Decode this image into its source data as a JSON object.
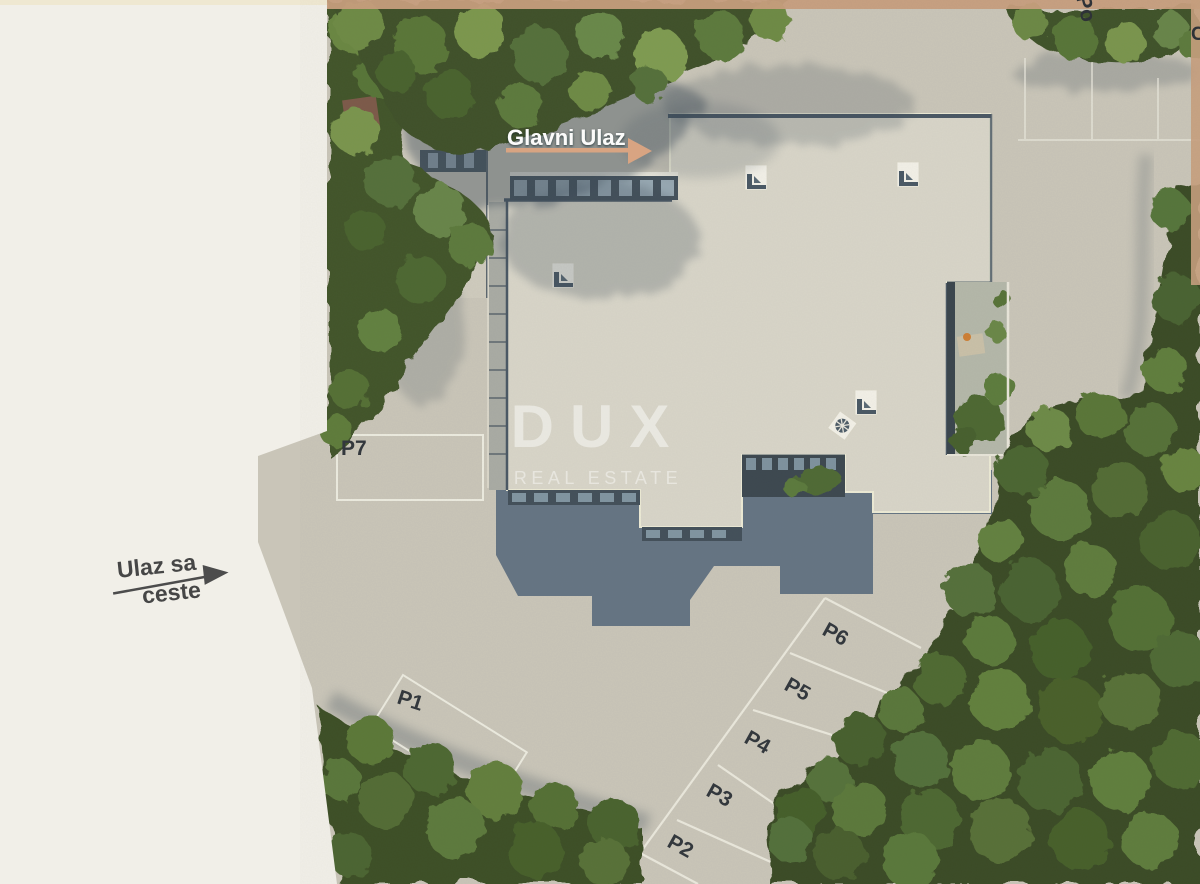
{
  "annotations": {
    "main_entrance": {
      "label": "Glavni Ulaz"
    },
    "road_entrance": {
      "line1": "Ulaz sa",
      "line2": "ceste"
    },
    "top_road_label_partial": "Po",
    "right_edge_label_partial": "C"
  },
  "watermark": {
    "brand": "DUX",
    "tagline": "REAL ESTATE"
  },
  "parking_spots": [
    "P1",
    "P2",
    "P3",
    "P4",
    "P5",
    "P6",
    "P7"
  ],
  "palette": {
    "cream_margin": "#f1efe8",
    "pavement": "#c9c5b8",
    "roof": "#d8d5c8",
    "building_shadow": "#5c6d7e",
    "forest_green": "#3a4c26",
    "canopy_highlight": "#6d8a46",
    "entrance_arrow_tan": "#d8a482",
    "border_strip_tan": "#c79e7d",
    "label_dark": "#33383d",
    "marking_white": "#efede2"
  }
}
